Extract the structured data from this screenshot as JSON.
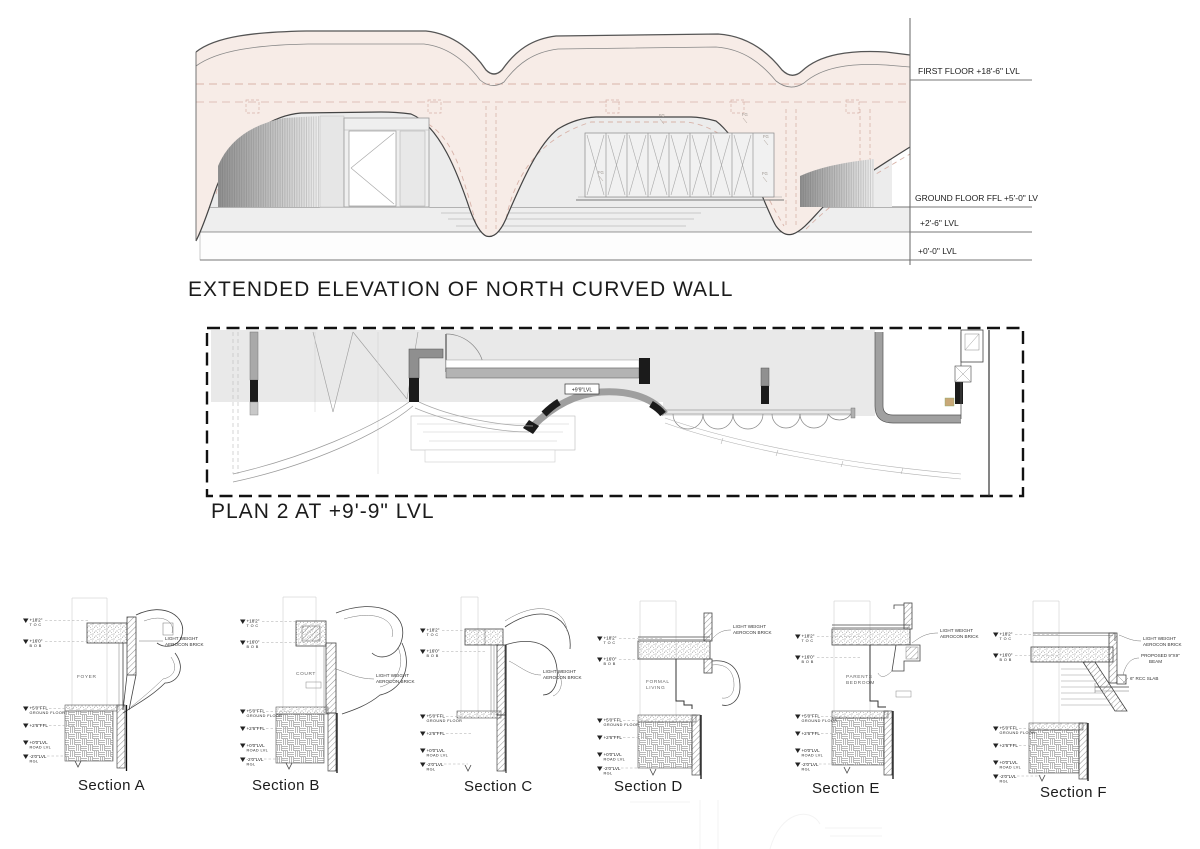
{
  "colors": {
    "wall_pink": "#f7ece7",
    "opening_gray": "#ececec",
    "dash_pink": "#d4aca2",
    "line": "#4a4a4a"
  },
  "elevation": {
    "title": "EXTENDED ELEVATION OF NORTH CURVED WALL",
    "levels": [
      "FIRST FLOOR +18'-6\" LVL",
      "GROUND FLOOR FFL +5'-0\" LVL",
      "+2'-6\" LVL",
      "+0'-0\" LVL"
    ],
    "fg_tag": "FG"
  },
  "plan": {
    "title": "PLAN 2  AT +9'-9\" LVL",
    "level_tag": "+9'9\"LVL"
  },
  "sections": {
    "titles": [
      "Section A",
      "Section B",
      "Section C",
      "Section D",
      "Section E",
      "Section F"
    ],
    "rooms": {
      "a": "FOYER",
      "b": "COURT",
      "d1": "FORMAL",
      "d2": "LIVING",
      "e1": "PARENTS",
      "e2": "BEDROOM"
    },
    "brick_note": {
      "l1": "LIGHT WEIGHT",
      "l2": "AEROCON BRICK"
    },
    "f_notes": {
      "beam_l1": "PROPOSED 9\"X9\"",
      "beam_l2": "BEAM",
      "slab": "6\" RCC SLAB"
    },
    "levels": {
      "toc_val": "+18'2\"",
      "toc_sub": "T O C",
      "bob_val": "+16'0\"",
      "bob_sub": "B O B",
      "ffl_val": "+5'0\"FFL",
      "ffl_sub": "GROUND FLOOR",
      "l26_val": "+2'6\"FFL",
      "road_val": "+0'0\"LVL",
      "road_sub": "ROAD LVL",
      "rgl_val": "-2'0\"LVL",
      "rgl_sub": "RGL"
    }
  }
}
